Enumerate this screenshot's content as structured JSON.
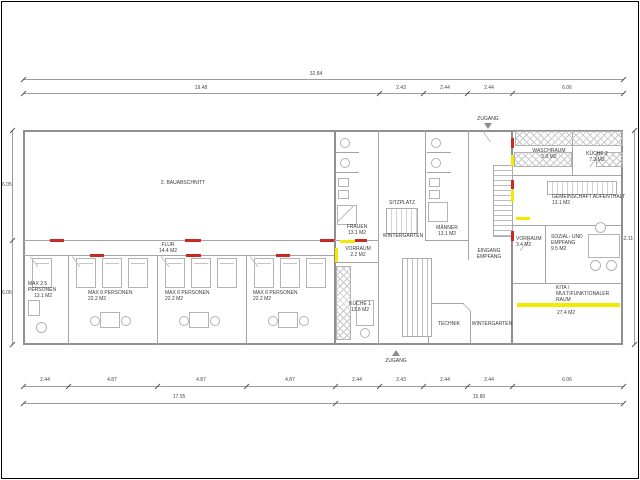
{
  "drawing": {
    "type": "architectural floor plan",
    "colors": {
      "wall": "#909090",
      "new_marking_red": "#c62a22",
      "demolition_marking_yellow": "#f2ea00"
    }
  },
  "dims": {
    "top_total": "32.84",
    "top_segs": [
      "19.48",
      "2.43",
      "2.44",
      "2.44",
      "6.06"
    ],
    "bottom_segs": [
      "2.44",
      "4.87",
      "4.87",
      "4.87",
      "2.44",
      "2.43",
      "2.44",
      "2.44",
      "6.06"
    ],
    "bottom_totals": [
      "17.05",
      "15.80"
    ],
    "left_segs": [
      "6.05",
      "6.06"
    ],
    "right_total": "12.11"
  },
  "rooms": {
    "bauabschnitt": {
      "name": "2. BAUABSCHNITT"
    },
    "flur": {
      "name": "FLUR",
      "area": "14.4 M2"
    },
    "bed1": {
      "name": "MAX 2.5",
      "name2": "PERSONEN",
      "area": "13.1 M2"
    },
    "bed2": {
      "name": "MAX 6 PERSONEN",
      "area": "22.2 M2"
    },
    "bed3": {
      "name": "MAX 6 PERSONEN",
      "area": "22.2 M2"
    },
    "bed4": {
      "name": "MAX 6 PERSONEN",
      "area": "22.2 M2"
    },
    "frauen": {
      "name": "FRAUEN",
      "area": "13.1 M2"
    },
    "sitzplatz": {
      "name": "SITZPLATZ"
    },
    "wintergarten1": {
      "name": "WINTERGARTEN"
    },
    "maenner": {
      "name": "MÄNNER",
      "area": "13.1 M2"
    },
    "eingang": {
      "name": "EINGANG",
      "name2": "EMPFANG"
    },
    "vorraum1": {
      "name": "VORRAUM",
      "area": "2.2 M2"
    },
    "kueche1": {
      "name": "KÜCHE 1",
      "area": "13.8 M2"
    },
    "technik": {
      "name": "TECHNIK"
    },
    "wintergarten2": {
      "name": "WINTERGARTEN"
    },
    "waschraum": {
      "name": "WASCHRAUM",
      "area": "5.0 M2"
    },
    "kueche2": {
      "name": "KÜCHE 2",
      "area": "7.3 M2"
    },
    "gemeinschaft": {
      "name": "GEMEINSCHAFT AUFENTHALT",
      "area": "13.1 M2"
    },
    "vorraum2": {
      "name": "VORRAUM",
      "area": "3.4 M2"
    },
    "sozial": {
      "name": "SOZIAL- UND",
      "name2": "EMPFANG",
      "area": "9.5 M2"
    },
    "kita": {
      "name": "KITA /",
      "name2": "MULTIFUNKTIONALER",
      "name3": "RAUM",
      "area": "27.4 M2"
    },
    "zugang_top": {
      "name": "ZUGANG"
    },
    "zugang_bottom": {
      "name": "ZUGANG"
    }
  }
}
